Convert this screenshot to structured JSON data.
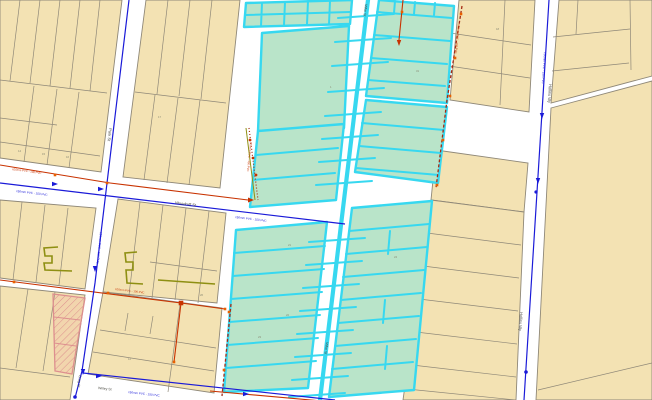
{
  "map": {
    "streets": {
      "park": "Park St",
      "woodruff": "Woodruff St",
      "craig": "Craig St",
      "wriley": "Wriley St",
      "millar": "Millar St",
      "hollins": "Hollins Wy"
    },
    "pipes": {
      "blue_label": "150mm PVC - 150 PVC",
      "red_label": "100mm PVC - 100 PVC"
    },
    "lots": {
      "a": "14",
      "b": "15",
      "c": "16",
      "d": "12",
      "e": "21",
      "f": "22",
      "g": "24",
      "h": "26",
      "i": "31",
      "j": "18",
      "k": "23",
      "l": "17",
      "m": "1"
    },
    "colors": {
      "parcel_fill": "#f3e2b3",
      "parcel_stroke": "#8f8878",
      "selection_green": "#b9e4c9",
      "selection_cyan": "#37d8f0",
      "water_main_blue": "#1a1ad8",
      "pipe_red": "#c83200",
      "pipe_dashed_red": "#a52a14",
      "marker_orange": "#e86000",
      "easement_olive": "#8e8f12",
      "hatch_pink": "#dd8f8f",
      "hatch_tint": "rgba(235,150,140,0.16)",
      "street_white": "#ffffff",
      "street_text": "#4a4a42",
      "lot_text": "#8a8a74"
    }
  }
}
